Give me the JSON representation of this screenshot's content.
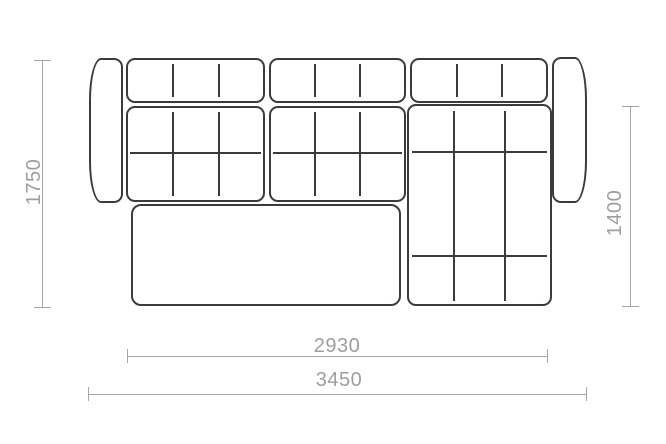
{
  "dimensions": {
    "height_total": {
      "label": "1750"
    },
    "chaise_depth": {
      "label": "1400"
    },
    "width_inner": {
      "label": "2930"
    },
    "width_total": {
      "label": "3450"
    }
  },
  "colors": {
    "outline": "#3b3b3b",
    "dimension_line": "#a6a6a6",
    "dimension_text": "#9e9e9e",
    "background": "#ffffff"
  }
}
